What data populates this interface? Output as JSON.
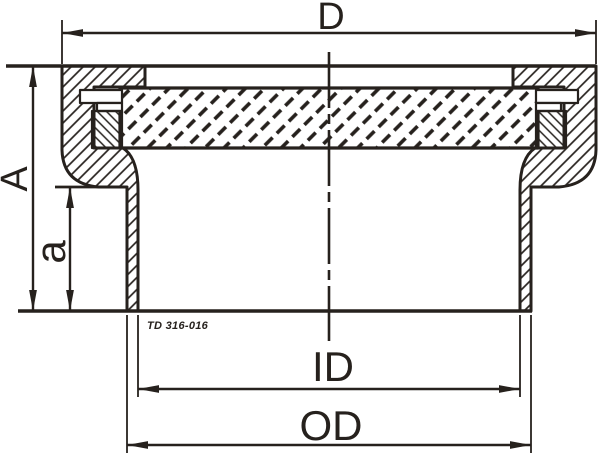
{
  "figure": {
    "type": "technical-section-drawing",
    "part_note": "TD 316-016",
    "dimensions": {
      "top_diameter": "D",
      "overall_height": "A",
      "inner_height": "a",
      "inner_diameter": "ID",
      "outer_diameter": "OD"
    },
    "colors": {
      "ink": "#26211d",
      "background": "#ffffff"
    }
  }
}
